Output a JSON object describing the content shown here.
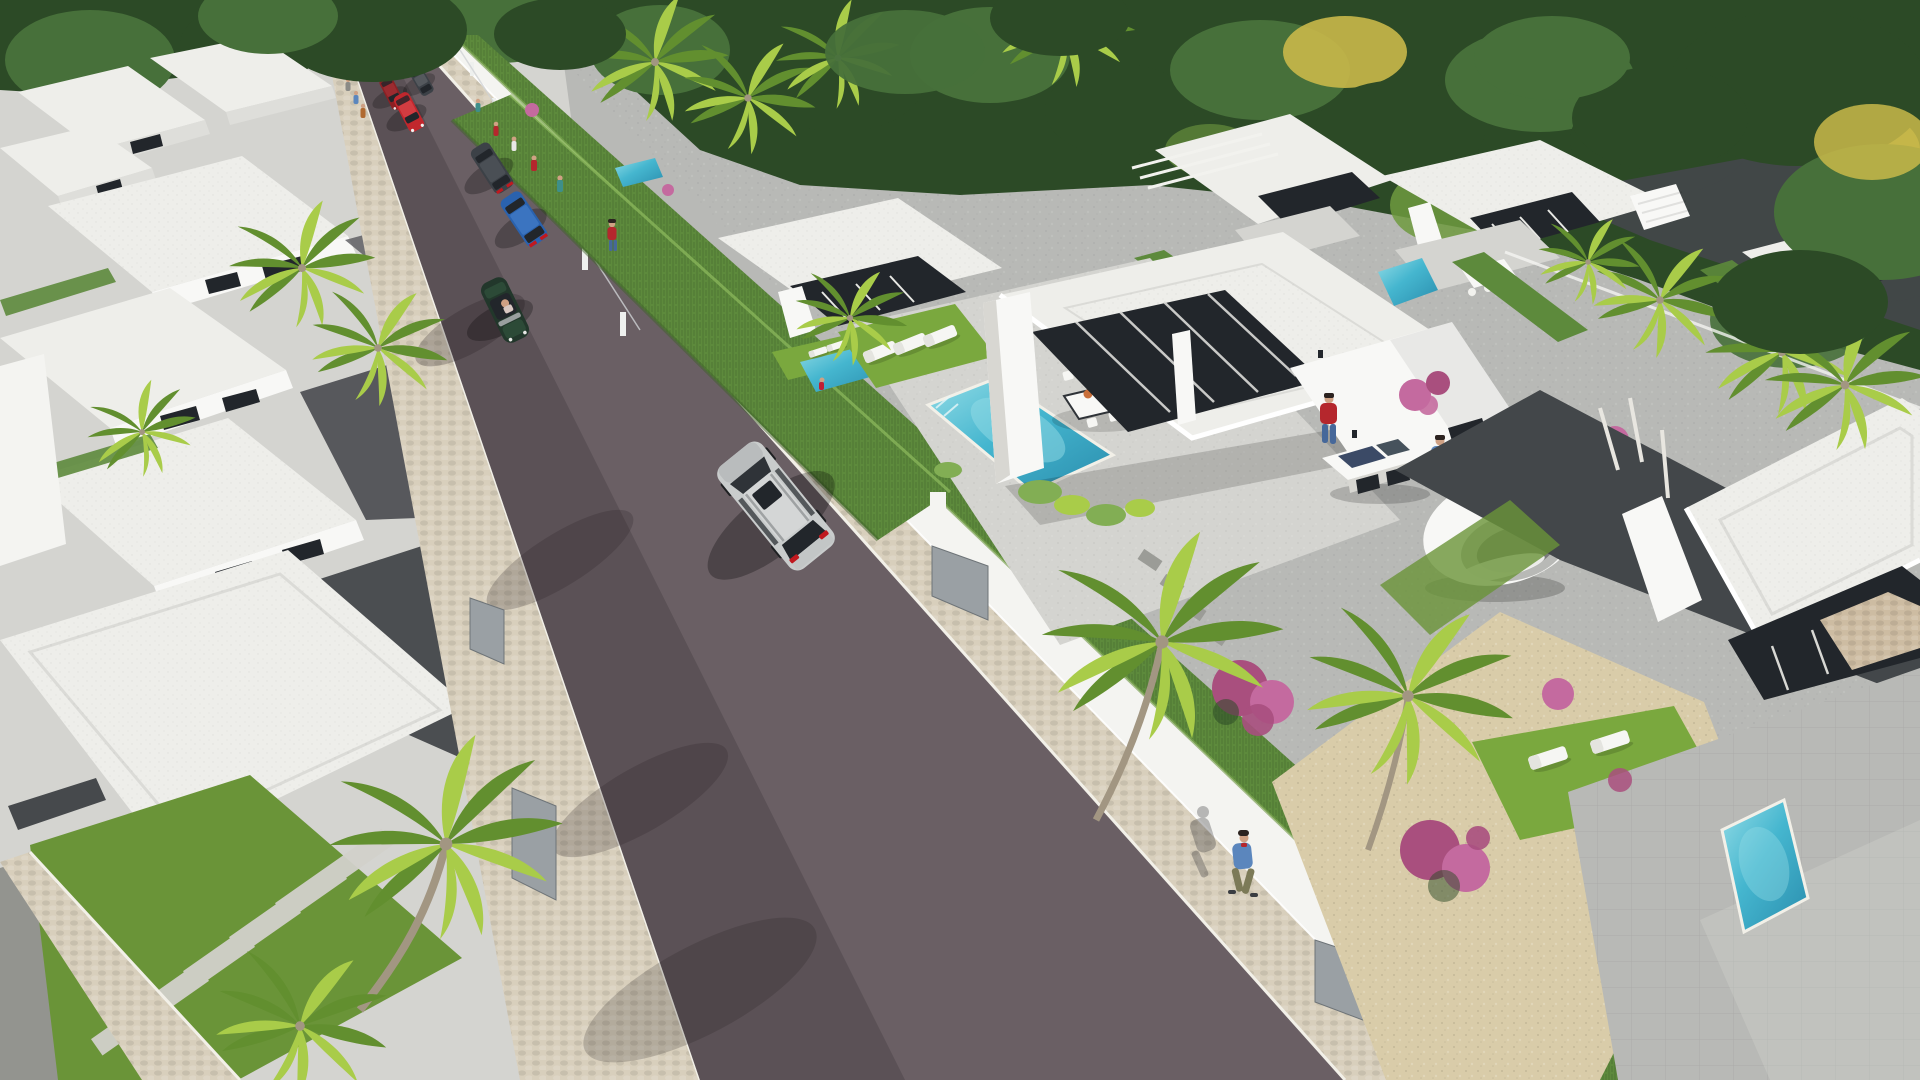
{
  "image": {
    "kind": "3D architectural rendering",
    "subject": "Aerial 3D render of a modern white-villa residential development: a straight asphalt street with cars and pedestrians runs between rows of single-storey flat-roofed villas with private turquoise pools, sun loungers, palm trees, hedges and dense woodland behind",
    "visible_text": "none",
    "width_px": 1920,
    "height_px": 1080
  },
  "colors": {
    "forestDark": "#2c4a26",
    "forestMid": "#47703a",
    "forestLight": "#6f9a3f",
    "treeYellow": "#c9b84a",
    "lawn": "#7aa83e",
    "lawnDeep": "#6a9438",
    "hedge": "#5d8a3c",
    "hedgeLight": "#82ae54",
    "palmLight": "#a9cc49",
    "palmDark": "#628f2f",
    "trunk": "#a29682",
    "road": "#6a5f64",
    "roadShadow": "#4b4348",
    "sidewalk": "#d8cfbc",
    "curb": "#f2f0e8",
    "wallWhite": "#f4f4f1",
    "wallShade": "#d8d7d2",
    "pavingLight": "#d4d4d0",
    "pavingMid": "#b8b9b6",
    "pavingDark": "#93948f",
    "courtyard": "#57585c",
    "driveway": "#43474a",
    "villaWhite": "#f8f8f6",
    "villaShade": "#dededa",
    "roofWhite": "#eeeeea",
    "glassDark": "#22262b",
    "glassBlue": "#46525c",
    "pool": "#45b6cf",
    "poolLight": "#93dce6",
    "poolDeep": "#2a8dad",
    "gravelSand": "#d9cca9",
    "stoneClad": "#cdbca2",
    "flowerPink": "#c46a9f",
    "flowerMagenta": "#a94f7e",
    "carRed": "#c1272d",
    "carDarkRed": "#8c2024",
    "carBlue": "#2a62ae",
    "carGreen": "#22372b",
    "carSilver": "#c9cccc",
    "carGrey": "#3c4147",
    "taillight": "#c0191f",
    "skin": "#cfa184",
    "hairDark": "#2c2320",
    "shirtRed": "#b5272d",
    "shirtBlue": "#5b86bd",
    "shirtWhite": "#e8e8e6",
    "shirtTeal": "#3e8f8a",
    "jeans": "#46689a",
    "pantsOlive": "#7c7a58",
    "swimRed": "#c01f32",
    "plateOrange": "#c96f3a",
    "solarNavy": "#3b4a66"
  },
  "scene": {
    "view": "high-angle aerial perspective looking down a straight residential street",
    "street": {
      "surface": "dark asphalt with paver texture",
      "left_side": "pale cobble sidewalk, hedges, louvred gates and white garden walls of the left villa row",
      "right_side": "beige cobblestone walkway along a low white boundary wall with glass-panel fencing and grey louvred gates",
      "vehicles": [
        {
          "name": "silver-hatchback-distant",
          "heading": "away"
        },
        {
          "name": "grey-car-distant",
          "heading": "away"
        },
        {
          "name": "dark-red-car",
          "heading": "toward"
        },
        {
          "name": "red-car",
          "heading": "toward"
        },
        {
          "name": "dark-grey-suv",
          "heading": "away"
        },
        {
          "name": "blue-sedan",
          "heading": "away"
        },
        {
          "name": "dark-green-convertible",
          "heading": "toward",
          "note": "open top, driver visible"
        },
        {
          "name": "silver-suv-foreground",
          "heading": "away",
          "note": "dark sunroof, red taillights"
        }
      ],
      "pedestrians_distant": 9,
      "pedestrian_foreground": "man in blue jacket and olive trousers walking beside the white wall"
    },
    "properties": {
      "left_row": "white flat-roofed villas with dark window slots, grey courtyards, hedges, slab paths and palm trees",
      "main_villa": {
        "features": [
          "L-shaped white villa with deep shaded porch and glass walls",
          "rectangular turquoise pool with white coping",
          "3 white sun loungers on a lawn patch",
          "white outdoor dining table with chairs and orange plates",
          "woman in red swimsuit on the terrace",
          "two men talking beside a white solar-panel table",
          "white crescent garden pod sculpture",
          "woman in red dress walking",
          "pink flowering shrubs and bright green bushes",
          "tall cypress hedge along the street"
        ]
      },
      "rear_row": "matching white villas with pergolas, small pools, dining sets and palms against the woodland",
      "bottom_right_villa": {
        "features": [
          "white canopy roof with glass facade and stone-clad wall",
          "grey tiled terrace",
          "small turquoise pool",
          "lawn with 2 white sun loungers",
          "sand-coloured gravel garden",
          "magenta bougainvillea shrubs",
          "dark paved driveway with white-trunk trees"
        ]
      }
    },
    "vegetation": {
      "woodland": "dense green trees with yellow accents along the top edge",
      "palms": "many, bright yellow-green fronds"
    },
    "pools_visible": 5,
    "people_total_visible": 15
  }
}
